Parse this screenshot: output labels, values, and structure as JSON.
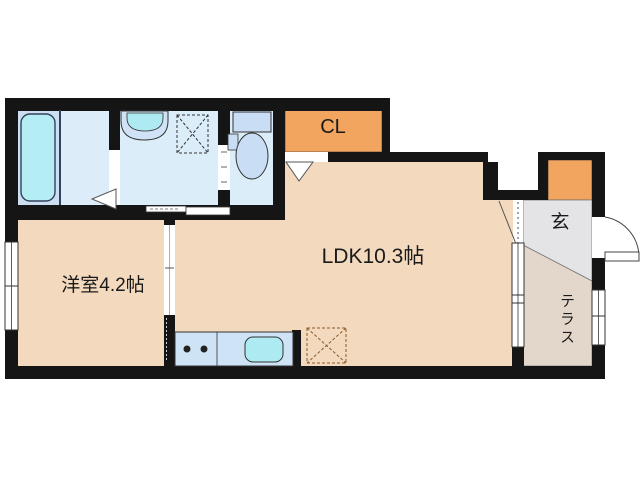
{
  "plan": {
    "type": "floorplan",
    "rooms": {
      "western_room": {
        "label": "洋室4.2帖"
      },
      "ldk": {
        "label": "LDK10.3帖"
      },
      "closet": {
        "label": "CL"
      },
      "entrance": {
        "label": "玄"
      },
      "terrace": {
        "label": "テラス"
      }
    },
    "fixtures": [
      "bathtub",
      "washbasin",
      "washing-machine-pan",
      "toilet",
      "kitchen-counter",
      "stove-burners",
      "kitchen-sink",
      "refrigerator-space",
      "entry-swing-door",
      "sliding-doors",
      "windows"
    ],
    "colors": {
      "wall": "#151515",
      "floor_beige": "#f3dabf",
      "wet_room_blue": "#daedf9",
      "bath_blue": "#ccdff2",
      "accent_orange": "#f1a55f",
      "fixture_cyan": "#b4eef4",
      "counter_blue": "#cfe3f7",
      "genkan_gray": "#e4e4e6",
      "terrace_tan": "#e3d7cc"
    }
  }
}
